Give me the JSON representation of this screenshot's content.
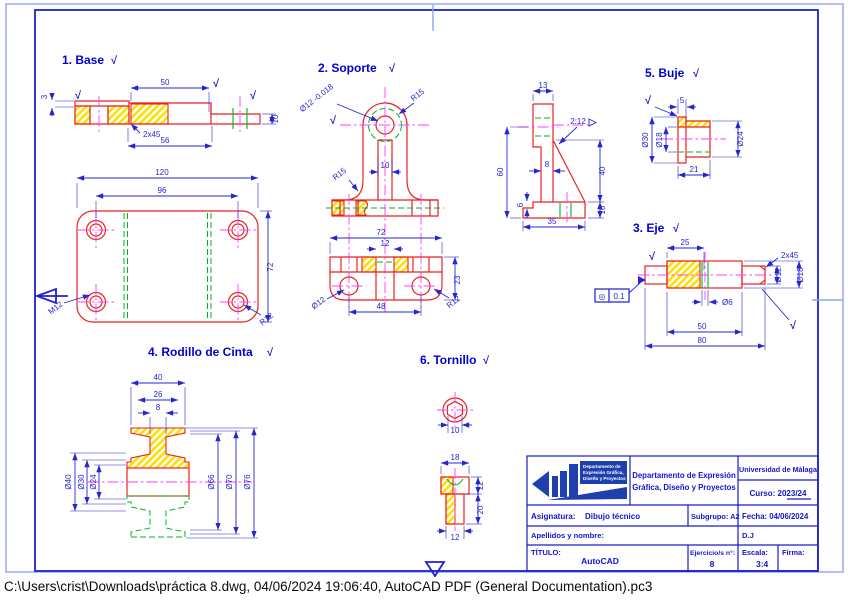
{
  "footer": {
    "text": "C:\\Users\\crist\\Downloads\\práctica 8.dwg, 04/06/2024 19:06:40, AutoCAD PDF (General Documentation).pc3"
  },
  "icons": {
    "finish": "√",
    "concentricity": "◎"
  },
  "parts": {
    "base": {
      "title": "1. Base",
      "front": {
        "d3": "3",
        "d50": "50",
        "chamfer": "2x45",
        "d56": "56",
        "d10": "10"
      },
      "plan": {
        "d120": "120",
        "d96": "96",
        "d72": "72",
        "thread": "M12",
        "radius": "R12"
      }
    },
    "soporte": {
      "title": "2. Soporte",
      "front": {
        "hole": "Ø12 -0.018",
        "r_top": "R15",
        "r_left": "R15",
        "slot": "10"
      },
      "bottom": {
        "d72": "72",
        "d12": "12",
        "d23": "23",
        "d48": "48",
        "hole": "Ø12",
        "radius": "R12"
      },
      "side": {
        "d13": "13",
        "d60": "60",
        "d8": "8",
        "d40": "40",
        "d10": "10",
        "d6": "6",
        "d35": "35",
        "note": "2:12"
      }
    },
    "eje": {
      "title": "3. Eje",
      "dims": {
        "d25": "25",
        "chamfer": "2x45",
        "dia12": "Ø12",
        "dia18": "Ø18",
        "dia6": "Ø6",
        "d50": "50",
        "d80": "80"
      },
      "tolerance": {
        "symbol": "◎",
        "value": "0.1"
      }
    },
    "rodillo": {
      "title": "4. Rodillo de Cinta",
      "dims": {
        "d40": "40",
        "d26": "26",
        "d8": "8",
        "dia40": "Ø40",
        "dia30": "Ø30",
        "dia24": "Ø24",
        "dia66": "Ø66",
        "dia70": "Ø70",
        "dia76": "Ø76"
      }
    },
    "buje": {
      "title": "5. Buje",
      "dims": {
        "d5": "5",
        "dia30": "Ø30",
        "dia18": "Ø18",
        "dia24": "Ø24",
        "d21": "21"
      }
    },
    "tornillo": {
      "title": "6. Tornillo",
      "dims": {
        "d10": "10",
        "d18": "18",
        "d12h": "12",
        "d20": "20",
        "d12s": "12"
      }
    }
  },
  "title_block": {
    "logo_lines": [
      "Departamento de",
      "Expresión Gráfica,",
      "Diseño y Proyectos"
    ],
    "department_line1": "Departamento de Expresión",
    "department_line2": "Gráfica, Diseño y Proyectos",
    "university": "Universidad de Málaga",
    "curso": "Curso: 2023/24",
    "asignatura_label": "Asignatura:",
    "asignatura_value": "Dibujo técnico",
    "subgrupo": "Subgrupo: A2",
    "fecha": "Fecha: 04/06/2024",
    "apellidos_label": "Apellidos y nombre:",
    "author": "D.J",
    "titulo_label": "TÍTULO:",
    "titulo_value": "AutoCAD",
    "ejercicio_label": "Ejercicio/s n°:",
    "ejercicio_value": "8",
    "escala_label": "Escala:",
    "escala_value": "3:4",
    "firma_label": "Firma:"
  }
}
